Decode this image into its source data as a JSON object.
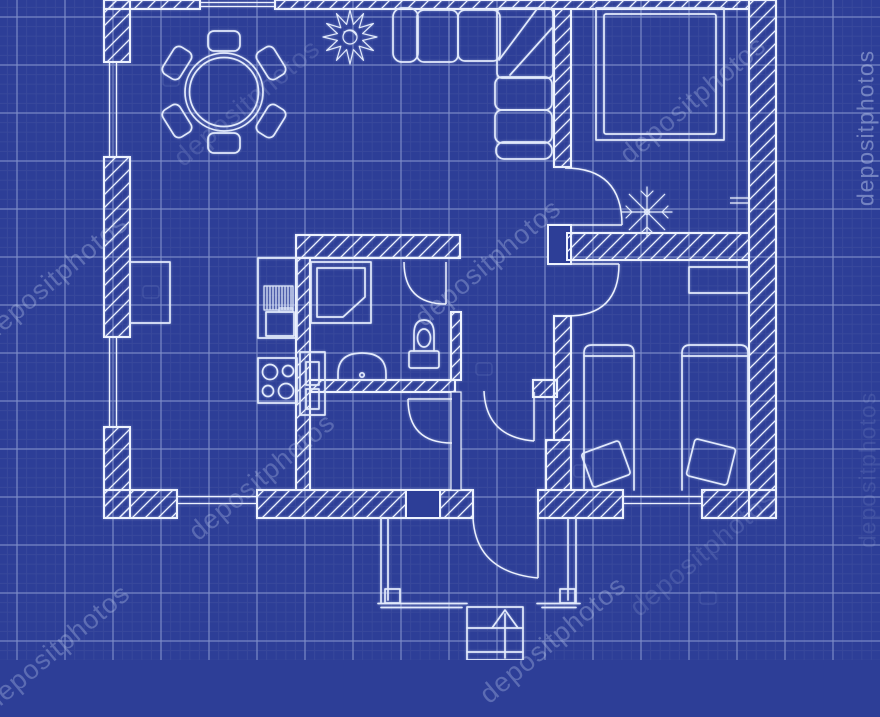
{
  "watermark": {
    "text": "depositphotos"
  },
  "colors": {
    "bg": "#2d3e97",
    "gridMinor": "#41519f",
    "gridMajor": "#8e9dd3",
    "line": "#edf2fe",
    "furn": "#e2eafc",
    "watermark": "#c9d6f4"
  },
  "plan": {
    "type": "apartment-floor-plan-blueprint",
    "furniture_icons": [
      "dining-table-icon",
      "chair-icon",
      "plant-icon",
      "corner-sofa-icon",
      "double-bed-icon",
      "single-bed-icon",
      "nightstand-icon",
      "kitchen-counter-icon",
      "stove-icon",
      "refrigerator-icon",
      "shower-icon",
      "washbasin-icon",
      "toilet-icon",
      "door-swing-icon",
      "window-icon",
      "stairs-icon",
      "entry-arrow-icon"
    ]
  }
}
